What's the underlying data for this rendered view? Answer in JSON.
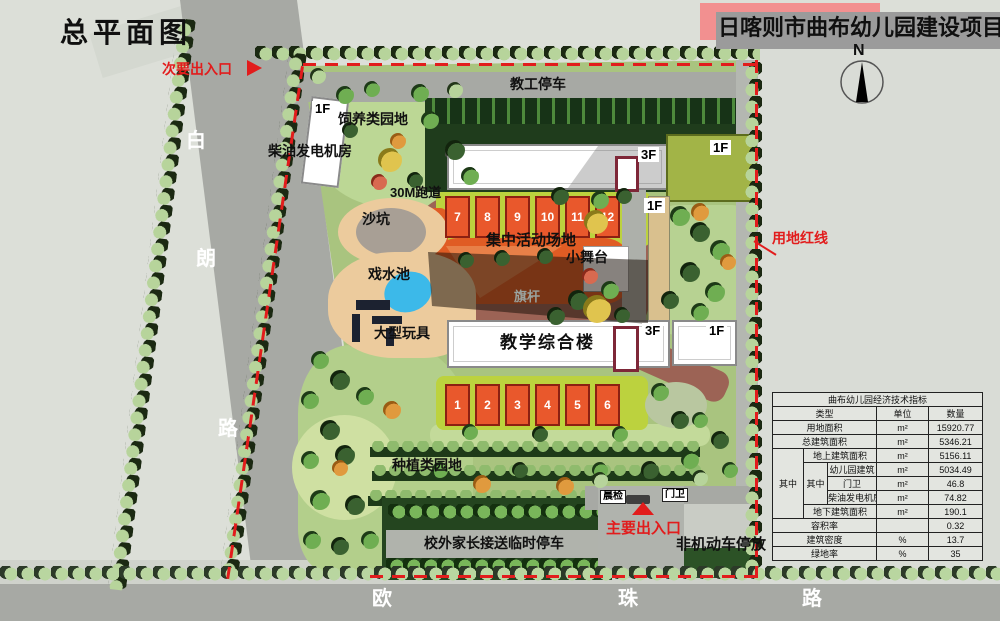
{
  "page_title": "总平面图",
  "banner": {
    "text": "日喀则市曲布幼儿园建设项目",
    "bg": "#f29090"
  },
  "compass": {
    "north": "N"
  },
  "roads": {
    "west": [
      "白",
      "朗",
      "路"
    ],
    "south": [
      "欧",
      "珠",
      "路"
    ]
  },
  "entrances": {
    "secondary": "次要出入口",
    "main": "主要出入口"
  },
  "boundary": {
    "red_line": "用地红线"
  },
  "areas": {
    "staff_parking": "教工停车",
    "breeding_garden": "饲养类园地",
    "generator_room": "柴油发电机房",
    "track": "30M跑道",
    "sandpit": "沙坑",
    "wading_pool": "戏水池",
    "activity_ground": "集中活动场地",
    "stage": "小舞台",
    "flagpole": "旗杆",
    "teaching_building": "教学综合楼",
    "large_toys": "大型玩具",
    "planting_garden": "种植类园地",
    "parent_parking": "校外家长接送临时停车",
    "non_motor_parking": "非机动车停放",
    "morning_check": "晨检",
    "guard_room": "门卫"
  },
  "floor_tags": {
    "f1": "1F",
    "f3": "3F"
  },
  "classrooms": {
    "upper": [
      "7",
      "8",
      "9",
      "10",
      "11",
      "12"
    ],
    "lower": [
      "1",
      "2",
      "3",
      "4",
      "5",
      "6"
    ]
  },
  "indicator_table": {
    "title": "曲布幼儿园经济技术指标",
    "col_type": "类型",
    "col_unit": "单位",
    "col_qty": "数量",
    "among": "其中",
    "rows": {
      "land": {
        "label": "用地面积",
        "unit": "m²",
        "qty": "15920.77"
      },
      "total": {
        "label": "总建筑面积",
        "unit": "m²",
        "qty": "5346.21"
      },
      "above": {
        "label": "地上建筑面积",
        "unit": "m²",
        "qty": "5156.11"
      },
      "kindergarten": {
        "label": "幼儿园建筑",
        "unit": "m²",
        "qty": "5034.49"
      },
      "guard": {
        "label": "门卫",
        "unit": "m²",
        "qty": "46.8"
      },
      "diesel": {
        "label": "柴油发电机房",
        "unit": "m²",
        "qty": "74.82"
      },
      "below": {
        "label": "地下建筑面积",
        "unit": "m²",
        "qty": "190.1"
      },
      "far": {
        "label": "容积率",
        "unit": "",
        "qty": "0.32"
      },
      "density": {
        "label": "建筑密度",
        "unit": "%",
        "qty": "13.7"
      },
      "green": {
        "label": "绿地率",
        "unit": "%",
        "qty": "35"
      }
    }
  },
  "colors": {
    "accent_red": "#e21c1c",
    "site_green": "#a9c47f",
    "block_orange": "#e9582c",
    "road_gray": "#a7a9a4"
  }
}
